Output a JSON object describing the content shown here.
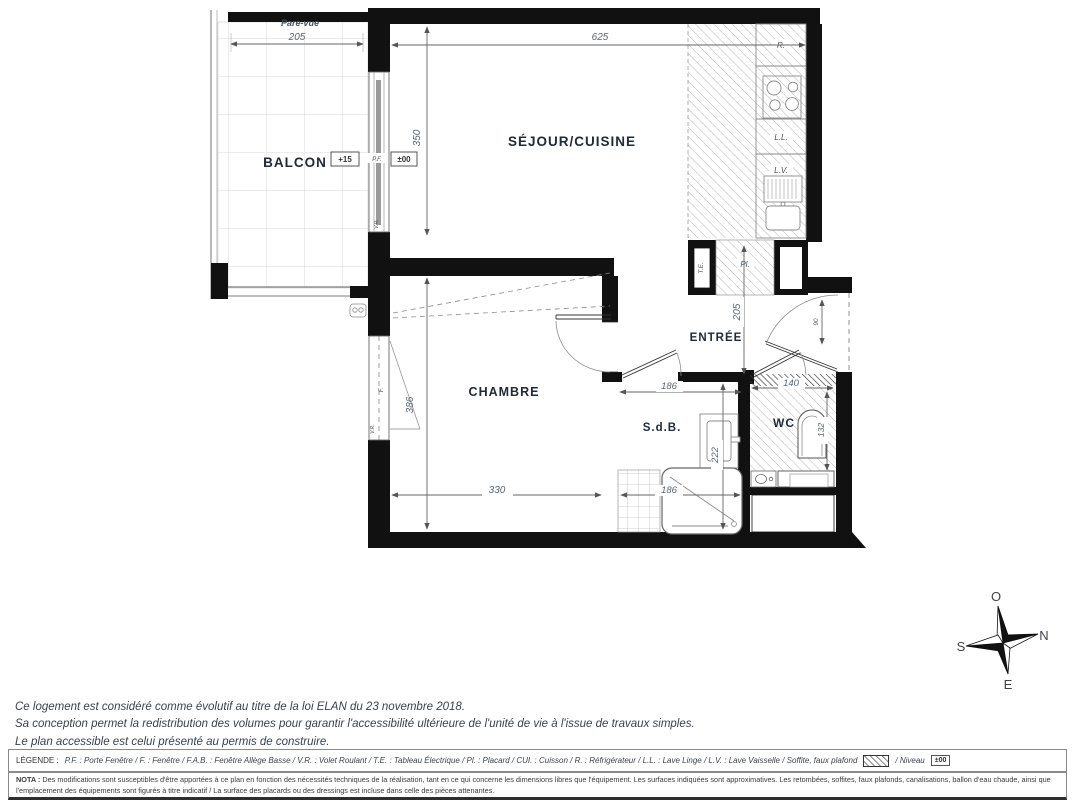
{
  "plan": {
    "rooms": {
      "balcon": "BALCON",
      "sejour": "SÉJOUR/CUISINE",
      "chambre": "CHAMBRE",
      "entree": "ENTRÉE",
      "sdb": "S.d.B.",
      "wc": "WC"
    },
    "tags": {
      "pare_vue": "Pare-vue",
      "pf": "P.F.",
      "vr_pf": "V.R.",
      "f": "F.",
      "vr_f": "V.R.",
      "te": "T.E.",
      "pl": "Pl.",
      "r": "R.",
      "ll": "L.L.",
      "lv": "L.V."
    },
    "levels": {
      "balcon": "+15",
      "sejour": "±00"
    },
    "dims": {
      "balcon_w": "205",
      "sejour_w": "625",
      "sejour_h": "350",
      "entree_h": "205",
      "door_w": "90",
      "chambre_h": "386",
      "chambre_w": "330",
      "sdb_w": "186",
      "sdb_h": "222",
      "bath_w": "186",
      "wc_w": "140",
      "wc_h": "132"
    }
  },
  "compass": {
    "o": "O",
    "n": "N",
    "s": "S",
    "e": "E"
  },
  "notes": {
    "line1": "Ce logement est considéré comme évolutif au titre de la loi ELAN du 23 novembre 2018.",
    "line2": "Sa conception permet la redistribution des volumes pour garantir l'accessibilité ultérieure de l'unité de vie à l'issue de travaux simples.",
    "line3": "Le plan accessible est celui présenté au permis de construire."
  },
  "legend": {
    "title": "LÉGENDE :",
    "items": "P.F. : Porte Fenêtre  /  F. : Fenêtre  /  F.A.B. : Fenêtre Allège Basse  /  V.R. : Volet Roulant  /  T.E. : Tableau Électrique  /  Pl. : Placard  /  CUI. : Cuisson  /  R. : Réfrigérateur  /  L.L. : Lave Linge  /  L.V. : Lave Vaisselle  /  Soffite, faux plafond",
    "niveau": "/  Niveau",
    "niveau_value": "±00"
  },
  "nota": {
    "title": "NOTA :",
    "text": "Des modifications sont susceptibles d'être apportées à ce plan en fonction des nécessités techniques de la réalisation, tant en ce qui concerne les dimensions libres que l'équipement. Les surfaces indiquées sont approximatives. Les retombées, soffites, faux plafonds, canalisations, ballon d'eau chaude, ainsi que l'emplacement des équipements sont figurés à titre indicatif / La surface des placards ou des dressings est incluse dans celle des pièces attenantes."
  }
}
